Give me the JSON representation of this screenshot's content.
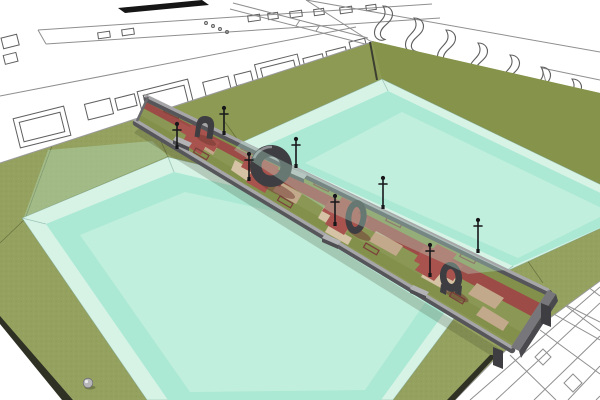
{
  "scene": {
    "style": "sketchup-style axonometric architectural rendering, no visible text",
    "subject": "Elevated promenade with red pathway, paving, benches, lamp posts and dark arch sculptures spanning a grass field between two rectangular reflecting pools, surrounded by white wireframe site-plan linework",
    "regions": {
      "top_left": "building site-plan bands with room rectangles, small dots and a solid black bar",
      "top_right": "planting-plan bands with S-shaped bed outlines",
      "bottom_right": "paving plan with diagonal grid lines and diamond insets",
      "center": "promenade crossing between upper and lower pools",
      "bottom_left": "grass bank with a small stone sphere"
    },
    "counts": {
      "pools": 2,
      "arch_sculptures": 4,
      "lamp_posts": 8,
      "benches": 4,
      "tan_pavers": 9,
      "planter_beds": 9,
      "stone_sphere": 1,
      "deck_support_legs": 2,
      "wavy_bed_shapes": 9,
      "plan_room_rectangles": 12,
      "paving_diamonds": 2
    }
  },
  "colors": {
    "background": "#ffffff",
    "grass": "#95a25f",
    "grassBank": "#85934b",
    "grassMid": "#8d9a53",
    "poolRim": "#d6f3e6",
    "poolWater": "#abe9d5",
    "poolSheen": "#c1efdd",
    "poolSpill": "#bfeeda",
    "deckGreen": "#8b9755",
    "deckStrip": "#82904c",
    "pathRed": "#9c4b46",
    "pathRedBright": "#a8534d",
    "paverTan": "#c3a98b",
    "paverTanLight": "#d6c3a5",
    "planterRed": "#7b3f3b",
    "railLight": "#a6a6a9",
    "railDark": "#55555a",
    "sculptureDark": "#3e3e42",
    "sculptureLight": "#8e8e93",
    "benchTop": "#b3b3b6",
    "lampBlack": "#17171a",
    "wireframe": "#8f8f8f",
    "wireframeDark": "#5f5f5f",
    "planBlack": "#161616",
    "shadowRed": "#6f3532",
    "groundShadow": "#3c4226",
    "edgeDark": "#2e3124",
    "sphereGray": "#b7b7ba"
  }
}
